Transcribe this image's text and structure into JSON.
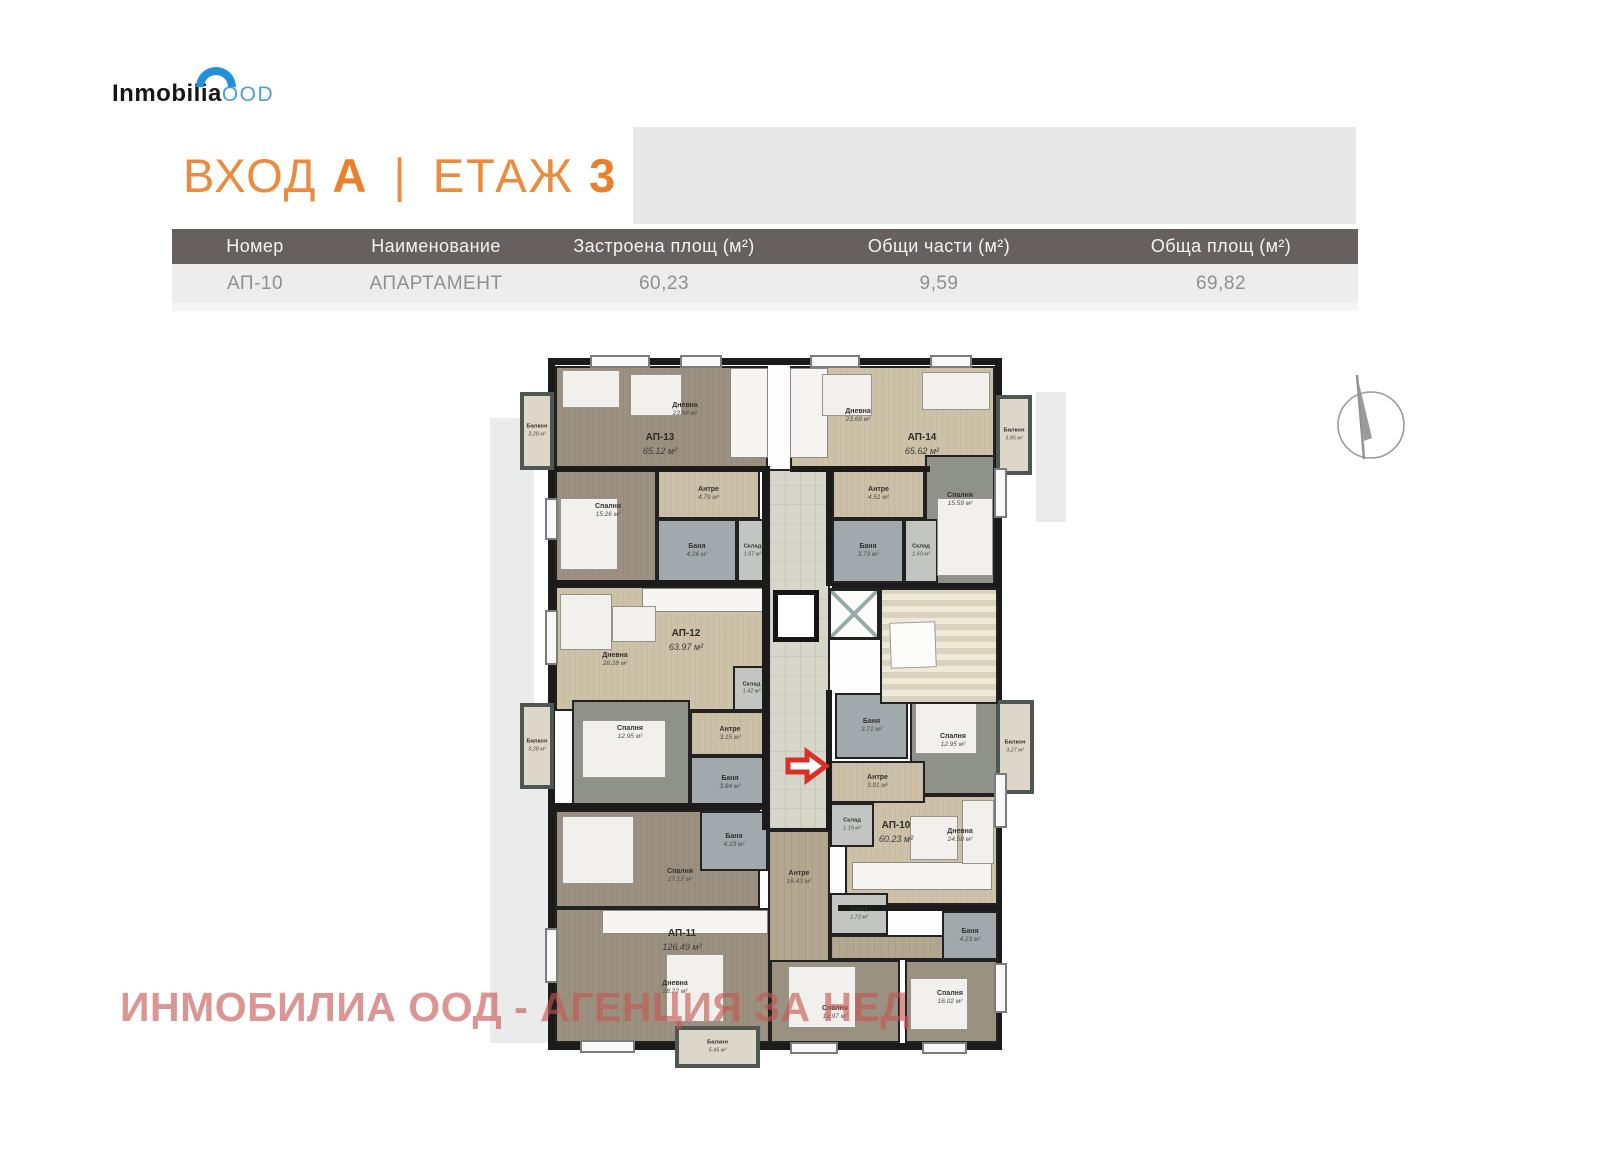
{
  "logo": {
    "brand": "Inmobilia",
    "suffix": "OOD"
  },
  "header": {
    "entrance_label": "ВХОД",
    "entrance_value": "А",
    "divider": "|",
    "floor_label": "ЕТАЖ",
    "floor_value": "3"
  },
  "table": {
    "columns": [
      "Номер",
      "Наименование",
      "Застроена площ (м²)",
      "Общи части (м²)",
      "Обща площ (м²)"
    ],
    "rows": [
      {
        "number": "АП-10",
        "name": "АПАРТАМЕНТ",
        "built_area": "60,23",
        "common_parts": "9,59",
        "total_area": "69,82"
      }
    ]
  },
  "watermark": "ИНМОБИЛИА ООД - АГЕНЦИЯ ЗА НЕД",
  "icons": {
    "compass": "compass-icon",
    "entrance_arrow": "entrance-arrow-icon"
  },
  "colors": {
    "accent_orange": "#ed8a3c",
    "table_header": "#676061",
    "watermark_red": "#c75450",
    "arrow_red": "#d93025"
  },
  "floorplan": {
    "apartment_labels": [
      {
        "id": "АП-13",
        "area": "65.12 м²",
        "x": 170,
        "y": 96
      },
      {
        "id": "АП-14",
        "area": "65.62 м²",
        "x": 432,
        "y": 96
      },
      {
        "id": "АП-12",
        "area": "63.97 м²",
        "x": 196,
        "y": 292
      },
      {
        "id": "АП-10",
        "area": "60.23 м²",
        "x": 406,
        "y": 484
      },
      {
        "id": "АП-11",
        "area": "126.49 м²",
        "x": 192,
        "y": 592
      }
    ],
    "rooms": [
      {
        "type": "corridor",
        "x": 278,
        "y": 121,
        "w": 62,
        "h": 361
      },
      {
        "type": "hallwood",
        "name": "Антре",
        "area": "16.43 м²",
        "x": 278,
        "y": 482,
        "w": 62,
        "h": 140,
        "lx": 309,
        "ly": 530
      },
      {
        "type": "hallwood",
        "x": 340,
        "y": 587,
        "w": 168,
        "h": 25
      },
      {
        "type": "living-dark",
        "name": "Дневна",
        "area": "23.98 м²",
        "x": 65,
        "y": 18,
        "w": 213,
        "h": 103,
        "lx": 195,
        "ly": 62
      },
      {
        "type": "living-light",
        "name": "Дневна",
        "area": "23.69 м²",
        "x": 300,
        "y": 18,
        "w": 205,
        "h": 103,
        "lx": 368,
        "ly": 68
      },
      {
        "type": "living-light",
        "name": "Дневна",
        "area": "28.28 м²",
        "x": 65,
        "y": 238,
        "w": 215,
        "h": 125,
        "lx": 125,
        "ly": 312
      },
      {
        "type": "living-light",
        "name": "Дневна",
        "area": "24.58 м²",
        "x": 355,
        "y": 447,
        "w": 153,
        "h": 110,
        "lx": 470,
        "ly": 488
      },
      {
        "type": "living-dark",
        "name": "Дневна",
        "area": "28.22 м²",
        "x": 65,
        "y": 560,
        "w": 215,
        "h": 135,
        "lx": 185,
        "ly": 640
      },
      {
        "type": "living-dark",
        "name": "Спалня",
        "area": "15.26 м²",
        "x": 65,
        "y": 121,
        "w": 102,
        "h": 114,
        "lx": 118,
        "ly": 163
      },
      {
        "type": "bedroom-green",
        "name": "Спалня",
        "area": "15.59 м²",
        "x": 435,
        "y": 107,
        "w": 70,
        "h": 131,
        "lx": 470,
        "ly": 152
      },
      {
        "type": "bedroom-green",
        "name": "Спалня",
        "area": "12.95 м²",
        "x": 82,
        "y": 352,
        "w": 118,
        "h": 110,
        "lx": 140,
        "ly": 385
      },
      {
        "type": "bedroom-green",
        "name": "Спалня",
        "area": "12.95 м²",
        "x": 420,
        "y": 342,
        "w": 88,
        "h": 105,
        "lx": 463,
        "ly": 393
      },
      {
        "type": "living-dark",
        "name": "Спалня",
        "area": "17.12 м²",
        "x": 65,
        "y": 462,
        "w": 205,
        "h": 98,
        "lx": 190,
        "ly": 528
      },
      {
        "type": "bedroom-brown",
        "name": "Спалня",
        "area": "12.97 м²",
        "x": 280,
        "y": 612,
        "w": 130,
        "h": 83,
        "lx": 345,
        "ly": 665
      },
      {
        "type": "bedroom-brown",
        "name": "Спалня",
        "area": "16.02 м²",
        "x": 415,
        "y": 612,
        "w": 93,
        "h": 83,
        "lx": 460,
        "ly": 650
      },
      {
        "type": "hall",
        "name": "Антре",
        "area": "4.79 м²",
        "x": 167,
        "y": 121,
        "w": 103,
        "h": 50
      },
      {
        "type": "hall",
        "name": "Антре",
        "area": "4.51 м²",
        "x": 342,
        "y": 121,
        "w": 93,
        "h": 50
      },
      {
        "type": "hall",
        "name": "Антре",
        "area": "3.15 м²",
        "x": 200,
        "y": 363,
        "w": 80,
        "h": 45
      },
      {
        "type": "hall",
        "name": "Антре",
        "area": "3.91 м²",
        "x": 340,
        "y": 413,
        "w": 95,
        "h": 42
      },
      {
        "type": "bath",
        "name": "Баня",
        "area": "4.26 м²",
        "x": 167,
        "y": 171,
        "w": 80,
        "h": 64
      },
      {
        "type": "bath",
        "name": "Баня",
        "area": "3.73 м²",
        "x": 342,
        "y": 171,
        "w": 72,
        "h": 64
      },
      {
        "type": "bath",
        "name": "Баня",
        "area": "3.84 м²",
        "x": 200,
        "y": 408,
        "w": 80,
        "h": 54
      },
      {
        "type": "bath",
        "name": "Баня",
        "area": "3.71 м²",
        "x": 345,
        "y": 345,
        "w": 73,
        "h": 66
      },
      {
        "type": "bath",
        "name": "Баня",
        "area": "4.23 м²",
        "x": 210,
        "y": 463,
        "w": 68,
        "h": 60
      },
      {
        "type": "bath",
        "name": "Баня",
        "area": "4.23 м²",
        "x": 452,
        "y": 563,
        "w": 56,
        "h": 49
      },
      {
        "type": "storage",
        "name": "Склад",
        "area": "1.67 м²",
        "x": 247,
        "y": 171,
        "w": 31,
        "h": 64
      },
      {
        "type": "storage",
        "name": "Склад",
        "area": "1.69 м²",
        "x": 414,
        "y": 171,
        "w": 34,
        "h": 64
      },
      {
        "type": "storage",
        "name": "Склад",
        "area": "1.42 м²",
        "x": 243,
        "y": 318,
        "w": 37,
        "h": 45
      },
      {
        "type": "storage",
        "name": "Склад",
        "area": "1.19 м²",
        "x": 340,
        "y": 455,
        "w": 44,
        "h": 44
      },
      {
        "type": "storage",
        "name": "Склад",
        "area": "1.72 м²",
        "x": 340,
        "y": 545,
        "w": 58,
        "h": 42
      },
      {
        "type": "balcony",
        "name": "Балкон",
        "area": "3.28 м²",
        "x": 30,
        "y": 44,
        "w": 34,
        "h": 78
      },
      {
        "type": "balcony",
        "name": "Балкон",
        "area": "3.85 м²",
        "x": 506,
        "y": 47,
        "w": 36,
        "h": 80
      },
      {
        "type": "balcony",
        "name": "Балкон",
        "area": "3.28 м²",
        "x": 30,
        "y": 355,
        "w": 34,
        "h": 86
      },
      {
        "type": "balcony",
        "name": "Балкон",
        "area": "3.27 м²",
        "x": 506,
        "y": 352,
        "w": 38,
        "h": 94
      },
      {
        "type": "balcony",
        "name": "Балкон",
        "area": "5.45 м²",
        "x": 185,
        "y": 678,
        "w": 85,
        "h": 42
      }
    ]
  }
}
